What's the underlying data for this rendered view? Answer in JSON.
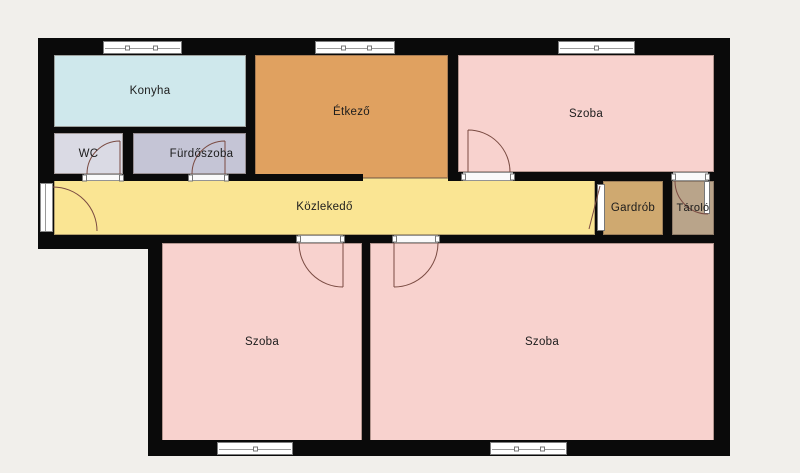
{
  "plan": {
    "rooms": {
      "konyha": {
        "label": "Konyha",
        "color": "#cfe8ec"
      },
      "etkezo": {
        "label": "Étkező",
        "color": "#e0a160"
      },
      "szoba_top": {
        "label": "Szoba",
        "color": "#f8d2ce"
      },
      "wc": {
        "label": "WC",
        "color": "#dadae4"
      },
      "furdoszoba": {
        "label": "Fürdőszoba",
        "color": "#c5c5d6"
      },
      "kozlekedo": {
        "label": "Közlekedő",
        "color": "#fae593"
      },
      "gardrob": {
        "label": "Gardrób",
        "color": "#cfa970"
      },
      "tarolo": {
        "label": "Tároló",
        "color": "#b9a48a"
      },
      "szoba_bl": {
        "label": "Szoba",
        "color": "#f8d2ce"
      },
      "szoba_br": {
        "label": "Szoba",
        "color": "#f8d2ce"
      }
    },
    "colors": {
      "background": "#f1efeb",
      "wall": "#0a0a0a",
      "door_swing": "#7a4b42",
      "label_text": "#1c1c1c"
    }
  }
}
